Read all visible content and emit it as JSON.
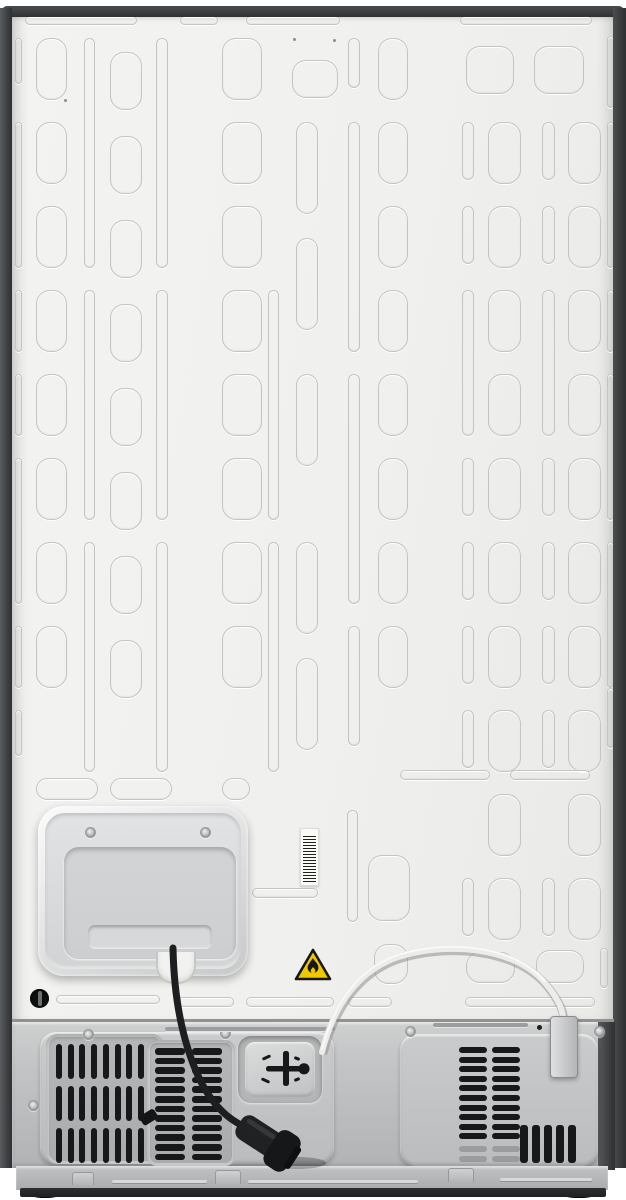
{
  "meta": {
    "title": "Rear view of a refrigerator",
    "description": "Product photo of a refrigerator back: embossed metal back panel, compressor access panel with two screws, vertical barcode sticker, flammable-material warning triangle, black power cord with plug, white water tube with fitting, and a lower machine compartment with ventilation grilles."
  },
  "colors": {
    "wall": "#f1f1ef",
    "emboss": "#c4c4c2",
    "slot": "#17181a",
    "warning_yellow": "#eec800",
    "cord_black": "#1d1e1f",
    "tube_light": "#ececea",
    "label": "#fafaf7"
  },
  "icons": [
    {
      "name": "flammable-warning-icon",
      "meaning": "caution flammable refrigerant"
    },
    {
      "name": "water-valve-icon",
      "meaning": "water inlet fitting"
    }
  ],
  "panel": {
    "emboss": [
      [
        25,
        16,
        112,
        9
      ],
      [
        180,
        16,
        38,
        9
      ],
      [
        246,
        16,
        94,
        9
      ],
      [
        460,
        16,
        132,
        9
      ],
      [
        15,
        38,
        7,
        46
      ],
      [
        15,
        122,
        7,
        146
      ],
      [
        15,
        290,
        7,
        62
      ],
      [
        15,
        374,
        7,
        62
      ],
      [
        15,
        458,
        7,
        146
      ],
      [
        15,
        626,
        7,
        62
      ],
      [
        15,
        710,
        7,
        46
      ],
      [
        36,
        38,
        31,
        62
      ],
      [
        36,
        122,
        31,
        62
      ],
      [
        36,
        206,
        31,
        62
      ],
      [
        36,
        290,
        31,
        62
      ],
      [
        36,
        374,
        31,
        62
      ],
      [
        36,
        458,
        31,
        62
      ],
      [
        36,
        542,
        31,
        62
      ],
      [
        36,
        626,
        31,
        62
      ],
      [
        84,
        38,
        11,
        230
      ],
      [
        84,
        290,
        11,
        230
      ],
      [
        84,
        542,
        11,
        230
      ],
      [
        110,
        52,
        32,
        58
      ],
      [
        110,
        136,
        32,
        58
      ],
      [
        110,
        220,
        32,
        58
      ],
      [
        110,
        304,
        32,
        58
      ],
      [
        110,
        388,
        32,
        58
      ],
      [
        110,
        472,
        32,
        58
      ],
      [
        110,
        556,
        32,
        58
      ],
      [
        110,
        640,
        32,
        58
      ],
      [
        156,
        38,
        12,
        230
      ],
      [
        156,
        290,
        12,
        230
      ],
      [
        156,
        542,
        12,
        230
      ],
      [
        222,
        38,
        40,
        62
      ],
      [
        222,
        122,
        40,
        62
      ],
      [
        222,
        206,
        40,
        62
      ],
      [
        222,
        290,
        40,
        62
      ],
      [
        222,
        374,
        40,
        62
      ],
      [
        222,
        458,
        40,
        62
      ],
      [
        222,
        542,
        40,
        62
      ],
      [
        222,
        626,
        40,
        62
      ],
      [
        292,
        60,
        46,
        38
      ],
      [
        296,
        122,
        22,
        92
      ],
      [
        296,
        238,
        22,
        92
      ],
      [
        296,
        374,
        22,
        92
      ],
      [
        296,
        542,
        22,
        92
      ],
      [
        296,
        658,
        22,
        92
      ],
      [
        268,
        290,
        11,
        230
      ],
      [
        268,
        542,
        11,
        230
      ],
      [
        348,
        38,
        12,
        50
      ],
      [
        348,
        122,
        12,
        230
      ],
      [
        348,
        374,
        12,
        230
      ],
      [
        348,
        626,
        12,
        120
      ],
      [
        347,
        810,
        11,
        112
      ],
      [
        378,
        38,
        30,
        62
      ],
      [
        378,
        122,
        30,
        62
      ],
      [
        378,
        206,
        30,
        62
      ],
      [
        378,
        290,
        30,
        62
      ],
      [
        378,
        374,
        30,
        62
      ],
      [
        378,
        458,
        30,
        62
      ],
      [
        378,
        542,
        30,
        62
      ],
      [
        378,
        626,
        30,
        62
      ],
      [
        368,
        855,
        42,
        66
      ],
      [
        374,
        944,
        34,
        40
      ],
      [
        466,
        46,
        48,
        48
      ],
      [
        534,
        46,
        50,
        48
      ],
      [
        462,
        122,
        12,
        58
      ],
      [
        462,
        206,
        12,
        58
      ],
      [
        462,
        290,
        12,
        146
      ],
      [
        462,
        458,
        12,
        58
      ],
      [
        462,
        542,
        12,
        58
      ],
      [
        462,
        626,
        12,
        58
      ],
      [
        462,
        710,
        12,
        58
      ],
      [
        462,
        878,
        12,
        58
      ],
      [
        488,
        122,
        33,
        62
      ],
      [
        488,
        206,
        33,
        62
      ],
      [
        488,
        290,
        33,
        62
      ],
      [
        488,
        374,
        33,
        62
      ],
      [
        488,
        458,
        33,
        62
      ],
      [
        488,
        542,
        33,
        62
      ],
      [
        488,
        626,
        33,
        62
      ],
      [
        488,
        710,
        33,
        62
      ],
      [
        488,
        794,
        33,
        62
      ],
      [
        488,
        878,
        33,
        62
      ],
      [
        542,
        122,
        13,
        58
      ],
      [
        542,
        206,
        13,
        58
      ],
      [
        542,
        290,
        13,
        146
      ],
      [
        542,
        458,
        13,
        58
      ],
      [
        542,
        542,
        13,
        58
      ],
      [
        542,
        626,
        13,
        58
      ],
      [
        542,
        710,
        13,
        58
      ],
      [
        542,
        878,
        13,
        58
      ],
      [
        568,
        122,
        33,
        62
      ],
      [
        568,
        206,
        33,
        62
      ],
      [
        568,
        290,
        33,
        62
      ],
      [
        568,
        374,
        33,
        62
      ],
      [
        568,
        458,
        33,
        62
      ],
      [
        568,
        542,
        33,
        62
      ],
      [
        568,
        626,
        33,
        62
      ],
      [
        568,
        710,
        33,
        62
      ],
      [
        568,
        794,
        33,
        62
      ],
      [
        568,
        878,
        33,
        62
      ],
      [
        607,
        36,
        7,
        72
      ],
      [
        607,
        122,
        7,
        146
      ],
      [
        607,
        290,
        7,
        62
      ],
      [
        607,
        374,
        7,
        146
      ],
      [
        607,
        542,
        7,
        146
      ],
      [
        607,
        688,
        7,
        60
      ],
      [
        466,
        952,
        49,
        31
      ],
      [
        536,
        950,
        48,
        33
      ],
      [
        600,
        948,
        8,
        40
      ],
      [
        36,
        778,
        62,
        22
      ],
      [
        110,
        778,
        62,
        22
      ],
      [
        222,
        778,
        28,
        22
      ],
      [
        56,
        995,
        104,
        9
      ],
      [
        178,
        997,
        56,
        10
      ],
      [
        246,
        997,
        88,
        10
      ],
      [
        348,
        997,
        44,
        10
      ],
      [
        465,
        997,
        130,
        10
      ],
      [
        252,
        888,
        66,
        10
      ],
      [
        400,
        770,
        90,
        10
      ],
      [
        510,
        770,
        80,
        10
      ]
    ],
    "dots": [
      [
        293,
        38
      ],
      [
        333,
        39
      ],
      [
        64,
        99
      ]
    ]
  },
  "access_panel": {
    "screws": [
      [
        85,
        827
      ],
      [
        200,
        827
      ]
    ]
  },
  "compartment": {
    "left_grille": {
      "x": 56,
      "y": 1044,
      "cols": 8,
      "rows": 3,
      "slot_w": 6,
      "slot_h": 35,
      "dx": 11.7,
      "dy": 42
    },
    "mid_grille": {
      "x": 155,
      "y": 1048,
      "cols": 2,
      "rows": 12,
      "slot_w": 30,
      "slot_h": 6.5,
      "dx": 37,
      "dy": 9.6
    },
    "right_grille": {
      "x": 459,
      "y": 1047,
      "cols": 2,
      "rows": 10,
      "slot_w": 28,
      "slot_h": 6,
      "dx": 33,
      "dy": 9.6,
      "ghost_rows": 2
    },
    "bottom_slots": {
      "x": 520,
      "y": 1125,
      "count": 5,
      "slot_w": 8,
      "slot_h": 38,
      "dx": 12
    },
    "rail_screws": [
      [
        83,
        1029
      ],
      [
        220,
        1028
      ],
      [
        405,
        1026
      ],
      [
        594,
        1026
      ],
      [
        28,
        1100
      ]
    ],
    "rail_dots": [
      [
        537,
        1025
      ]
    ],
    "rail_grooves": [
      [
        165,
        1027,
        170,
        4
      ],
      [
        433,
        1023,
        95,
        4
      ]
    ]
  },
  "base": {
    "tabs": [
      [
        72,
        1172,
        22,
        13
      ],
      [
        215,
        1170,
        26,
        14
      ],
      [
        448,
        1168,
        26,
        14
      ]
    ],
    "grooves": [
      [
        112,
        1180,
        95,
        3
      ],
      [
        248,
        1180,
        170,
        3
      ],
      [
        500,
        1178,
        92,
        3
      ]
    ],
    "feet": [
      [
        30,
        1189,
        30,
        9
      ],
      [
        562,
        1189,
        34,
        9
      ]
    ]
  }
}
